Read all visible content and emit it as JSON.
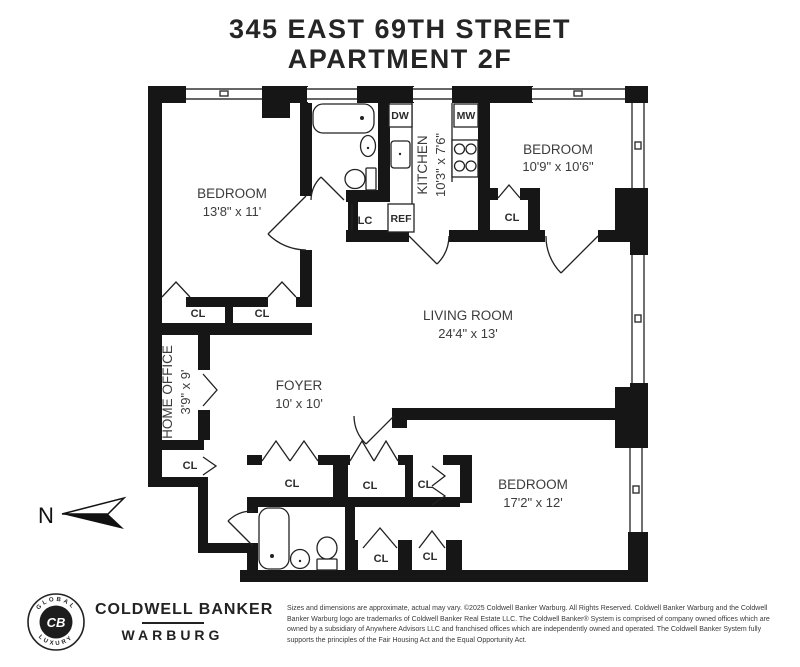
{
  "colors": {
    "wall": "#161616",
    "line": "#222222",
    "text": "#3c3c3c",
    "background": "#ffffff"
  },
  "title": {
    "line1": "345 EAST 69TH STREET",
    "line2": "APARTMENT 2F"
  },
  "compass": {
    "label": "N"
  },
  "rooms": {
    "bedroom1": {
      "name": "BEDROOM",
      "dims": "13'8\" x 11'"
    },
    "bedroom2": {
      "name": "BEDROOM",
      "dims": "10'9\" x 10'6\""
    },
    "bedroom3": {
      "name": "BEDROOM",
      "dims": "17'2\" x 12'"
    },
    "living": {
      "name": "LIVING ROOM",
      "dims": "24'4\" x 13'"
    },
    "kitchen": {
      "name": "KITCHEN",
      "dims": "10'3\" x 7'6\""
    },
    "foyer": {
      "name": "FOYER",
      "dims": "10' x 10'"
    },
    "home_office": {
      "name": "HOME OFFICE",
      "dims": "3'9\" x 9'"
    }
  },
  "closets": [
    {
      "label": "CL"
    },
    {
      "label": "CL"
    },
    {
      "label": "CL"
    },
    {
      "label": "CL"
    },
    {
      "label": "CL"
    },
    {
      "label": "CL"
    },
    {
      "label": "CL"
    },
    {
      "label": "CL"
    },
    {
      "label": "CL"
    }
  ],
  "linen_closet": {
    "label": "LC"
  },
  "appliances": {
    "dishwasher": "DW",
    "microwave": "MW",
    "refrigerator": "REF"
  },
  "footer": {
    "brand_line1": "COLDWELL BANKER",
    "brand_line2": "WARBURG",
    "seal_monogram": "CB",
    "seal_top": "GLOBAL",
    "seal_bottom": "LUXURY",
    "disclaimer": "Sizes and dimensions are approximate, actual may vary. ©2025 Coldwell Banker Warburg. All Rights Reserved. Coldwell Banker Warburg and the Coldwell Banker Warburg logo are trademarks of Coldwell Banker Real Estate LLC. The Coldwell Banker® System is comprised of company owned offices which are owned by a subsidiary of Anywhere Advisors LLC and franchised offices which are independently owned and operated. The Coldwell Banker System fully supports the principles of the Fair Housing Act and the Equal Opportunity Act."
  }
}
